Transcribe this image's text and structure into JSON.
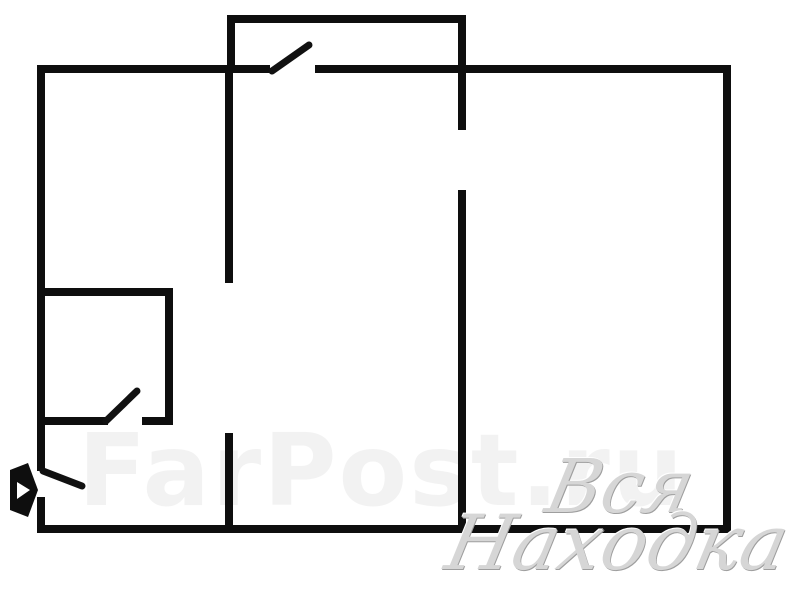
{
  "page": {
    "type": "apartment-floor-plan"
  },
  "colors": {
    "background": "#ffffff",
    "wall": "#0e0e0e",
    "door_leaf": "#111111",
    "watermark_faint": "rgba(0,0,0,0.05)",
    "watermark_script": "#d6d6d6",
    "watermark_script_edge": "#9e9e9e"
  },
  "plan": {
    "canvas": {
      "width": 800,
      "height": 615
    },
    "wall_thickness": 8,
    "walls": [
      {
        "name": "outer-top-wall-left-segment",
        "x": 37,
        "y": 65,
        "w": 233,
        "h": 8
      },
      {
        "name": "outer-top-wall-right-segment",
        "x": 315,
        "y": 65,
        "w": 415,
        "h": 8
      },
      {
        "name": "outer-left-wall-upper-segment",
        "x": 37,
        "y": 65,
        "w": 8,
        "h": 406
      },
      {
        "name": "outer-left-wall-lower-segment",
        "x": 37,
        "y": 497,
        "w": 8,
        "h": 36
      },
      {
        "name": "outer-bottom-wall",
        "x": 37,
        "y": 525,
        "w": 694,
        "h": 8
      },
      {
        "name": "outer-right-wall",
        "x": 723,
        "y": 65,
        "w": 8,
        "h": 468
      },
      {
        "name": "balcony-top-wall",
        "x": 227,
        "y": 15,
        "w": 239,
        "h": 8
      },
      {
        "name": "balcony-left-wall",
        "x": 227,
        "y": 15,
        "w": 8,
        "h": 54
      },
      {
        "name": "balcony-right-wall",
        "x": 458,
        "y": 15,
        "w": 8,
        "h": 115
      },
      {
        "name": "interior-wall-1-upper-segment",
        "x": 225,
        "y": 73,
        "w": 8,
        "h": 210
      },
      {
        "name": "interior-wall-1-lower-segment",
        "x": 225,
        "y": 433,
        "w": 8,
        "h": 96
      },
      {
        "name": "interior-wall-2",
        "x": 458,
        "y": 190,
        "w": 8,
        "h": 339
      },
      {
        "name": "small-room-top-wall",
        "x": 37,
        "y": 288,
        "w": 136,
        "h": 8
      },
      {
        "name": "small-room-right-wall",
        "x": 165,
        "y": 288,
        "w": 8,
        "h": 137
      },
      {
        "name": "small-room-bottom-wall-left",
        "x": 42,
        "y": 417,
        "w": 66,
        "h": 8
      },
      {
        "name": "small-room-bottom-wall-right",
        "x": 142,
        "y": 417,
        "w": 31,
        "h": 8
      }
    ],
    "door_leaves": [
      {
        "name": "balcony-door-leaf",
        "x1": 272,
        "y1": 71,
        "x2": 309,
        "y2": 45,
        "stroke_width": 7
      },
      {
        "name": "small-room-door-leaf",
        "x1": 106,
        "y1": 421,
        "x2": 137,
        "y2": 391,
        "stroke_width": 7
      },
      {
        "name": "entrance-door-leaf",
        "x1": 43,
        "y1": 471,
        "x2": 82,
        "y2": 486,
        "stroke_width": 7
      }
    ],
    "entrance_arrow": {
      "outer_points": "10,470 28,463 38,490 28,517 10,510",
      "inner_points": "17,482 30,490 17,499"
    }
  },
  "watermarks": {
    "site": {
      "text": "FarPost.ru"
    },
    "script_line1": {
      "text": "Вся"
    },
    "script_line2": {
      "text": "Находка"
    }
  }
}
